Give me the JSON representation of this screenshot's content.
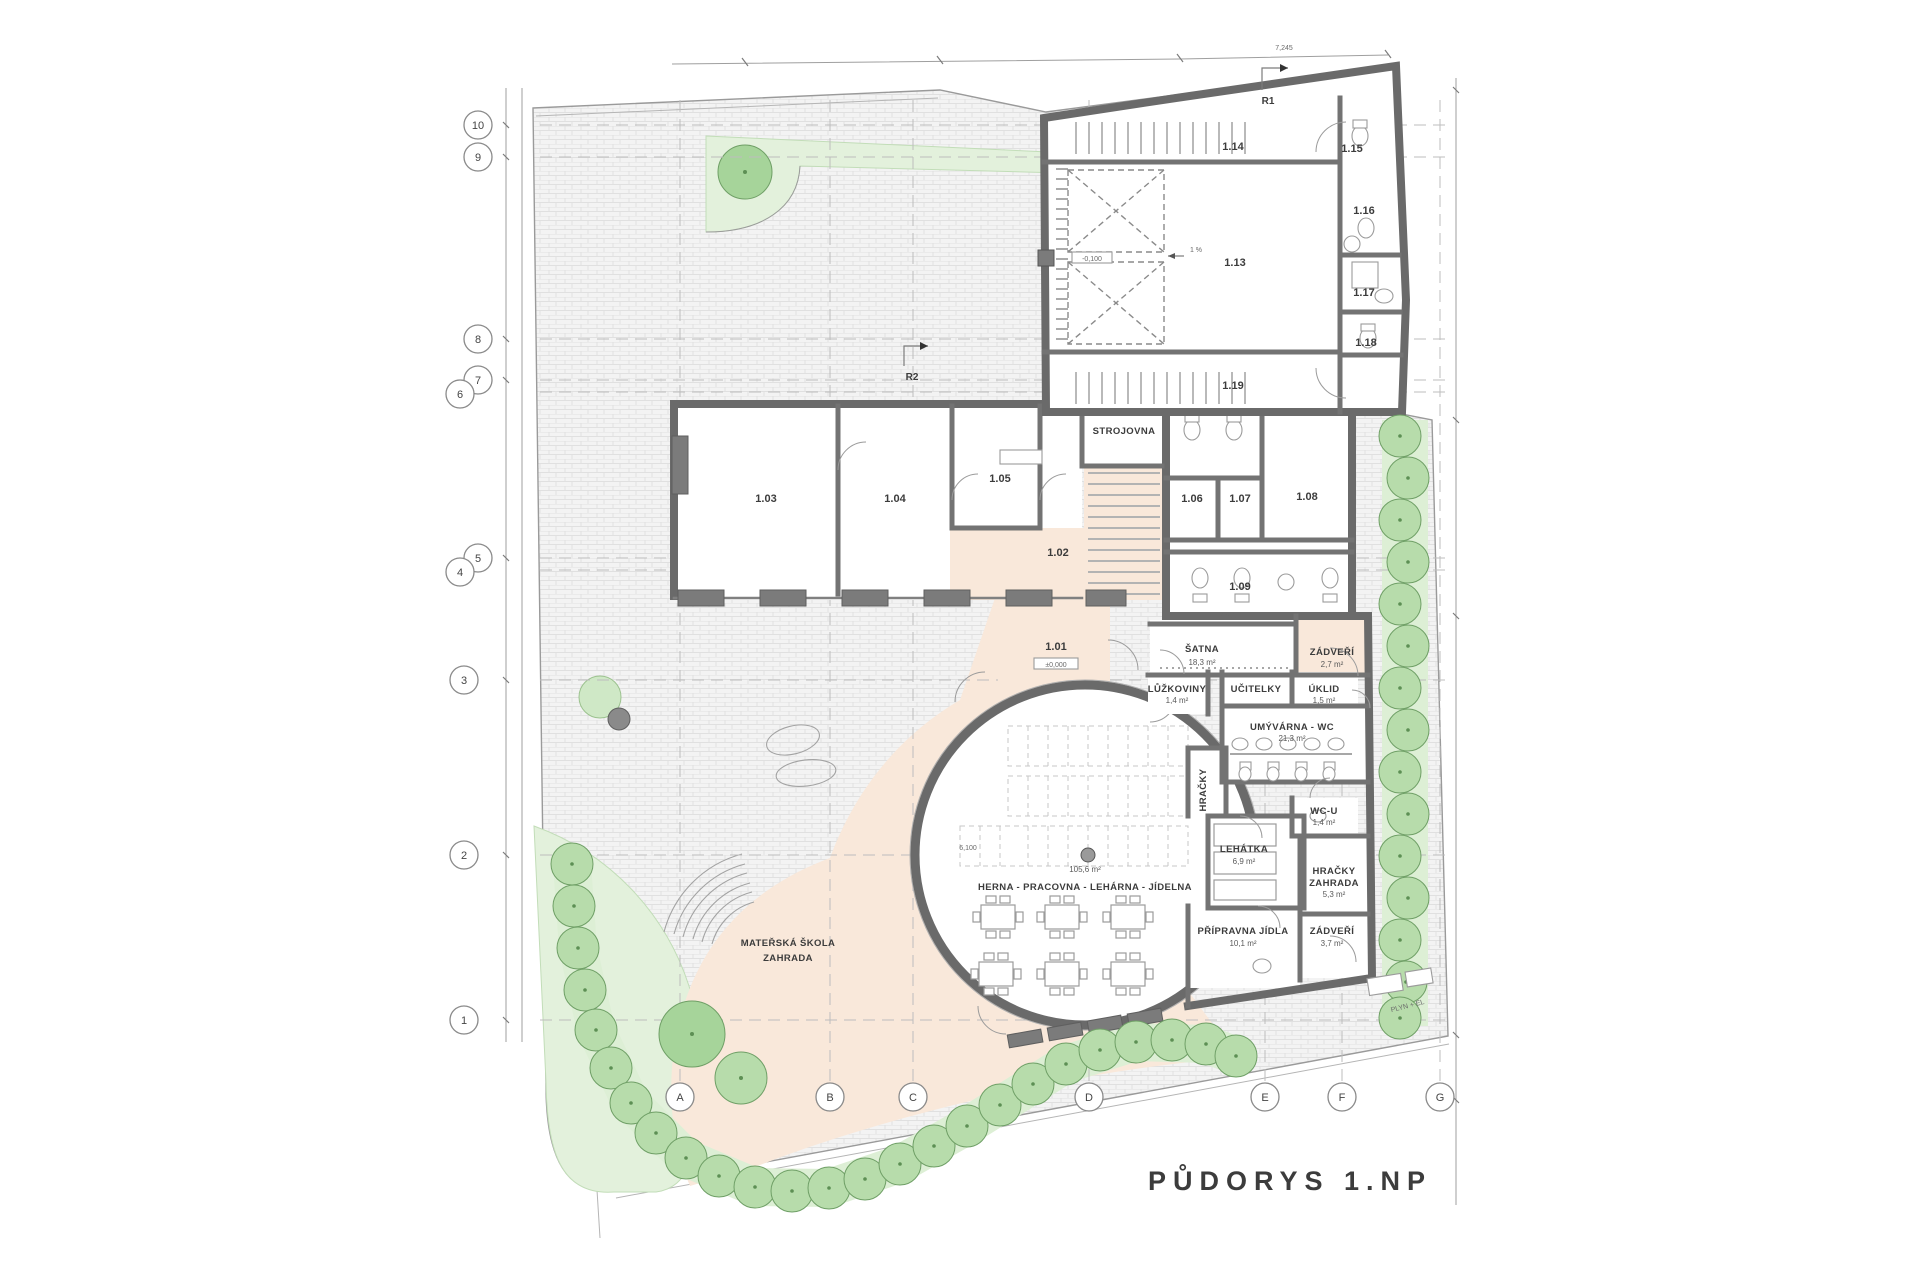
{
  "title": {
    "text": "PŮDORYS 1.NP"
  },
  "grid": {
    "rows": [
      "10",
      "9",
      "8",
      "7",
      "6",
      "5",
      "4",
      "3",
      "2",
      "1"
    ],
    "cols": [
      "A",
      "B",
      "C",
      "D",
      "E",
      "F",
      "G"
    ]
  },
  "hall": {
    "name": "HERNA - PRACOVNA - LEHÁRNA - JÍDELNA",
    "area": "105,6 m²"
  },
  "garden": {
    "line1": "MATEŘSKÁ ŠKOLA",
    "line2": "ZAHRADA"
  },
  "rooms": {
    "n101": "1.01",
    "n102": "1.02",
    "n103": "1.03",
    "n104": "1.04",
    "n105": "1.05",
    "n106": "1.06",
    "n107": "1.07",
    "n108": "1.08",
    "n109": "1.09",
    "n113": "1.13",
    "n114": "1.14",
    "n115": "1.15",
    "n116": "1.16",
    "n117": "1.17",
    "n118": "1.18",
    "n119": "1.19"
  },
  "named": {
    "strojovna": "STROJOVNA",
    "satna": "ŠATNA",
    "satna_area": "18,3 m²",
    "zadveri1": "ZÁDVEŘÍ",
    "zadveri1_area": "2,7 m²",
    "luzkoviny": "LŮŽKOVINY",
    "luzkoviny_area": "1,4 m²",
    "ucitelky": "UČITELKY",
    "uklid": "ÚKLID",
    "uklid_area": "1,5 m²",
    "umyvarna": "UMÝVÁRNA - WC",
    "umyvarna_area": "21,3 m²",
    "hracky": "HRAČKY",
    "wcu": "WC-U",
    "wcu_area": "1,4 m²",
    "lehatka": "LEHÁTKA",
    "lehatka_area": "6,9 m²",
    "hracky_zahrada1": "HRAČKY",
    "hracky_zahrada2": "ZAHRADA",
    "hracky_zahrada_area": "5,3 m²",
    "pripravna": "PŘÍPRAVNA JÍDLA",
    "pripravna_area": "10,1 m²",
    "zadveri2": "ZÁDVEŘÍ",
    "zadveri2_area": "3,7 m²"
  },
  "markers": {
    "r1": "R1",
    "r2": "R2",
    "utility": "PLYN + EL",
    "slope": "1 %"
  },
  "levels": {
    "l101": "±0,000",
    "l113": "-0,100"
  },
  "dims": {
    "top": "7,245",
    "satna": "7,550",
    "hall_left": "6,100"
  },
  "colors": {
    "accent_red": "#ff0000",
    "peach": "#f9e8da",
    "green_light": "#e3f1dc",
    "tree_fill": "#b7dcab",
    "paving_line": "#dedede"
  }
}
